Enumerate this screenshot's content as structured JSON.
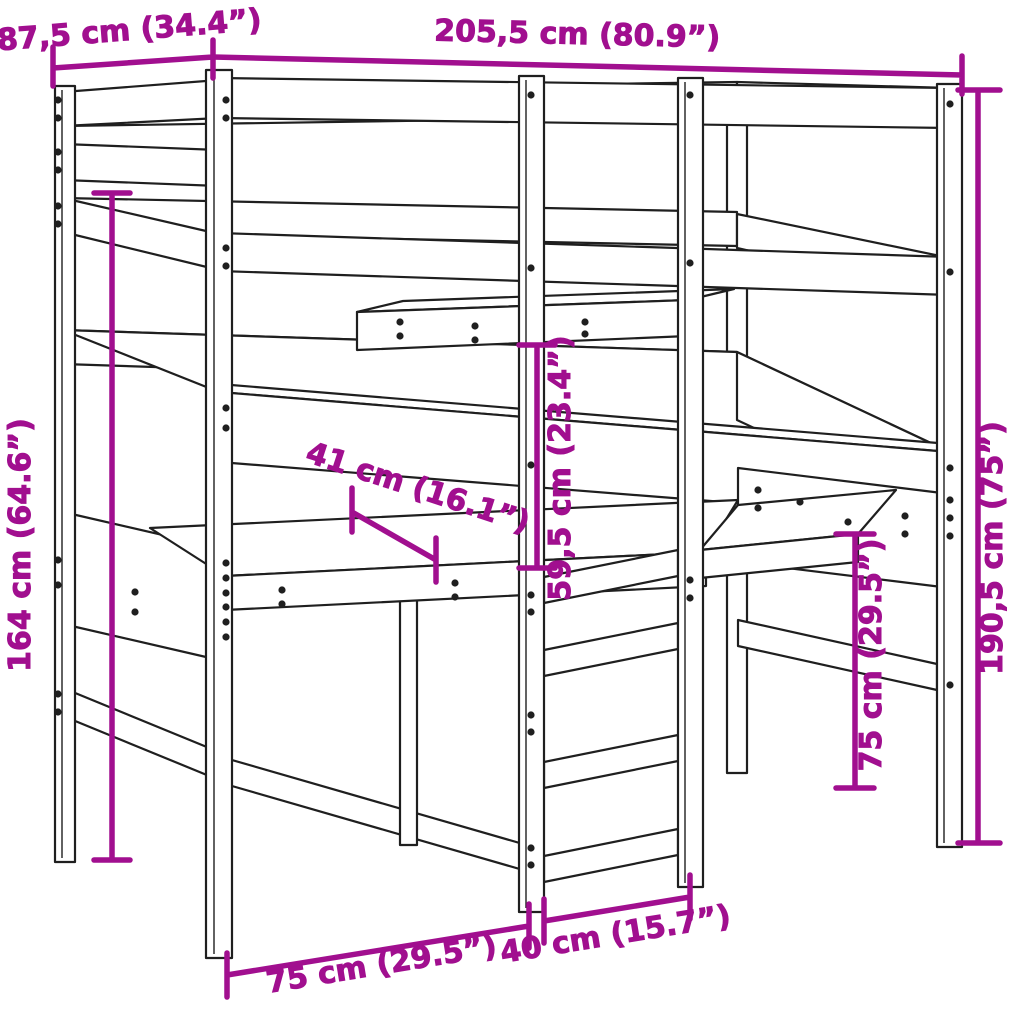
{
  "diagram": {
    "type": "furniture-dimension-diagram",
    "subject": "loft-bed-with-desks-and-ladder",
    "background": "#ffffff",
    "line_color": "#1f1f1f",
    "dimension_color": "#a10f8f",
    "dimensions": {
      "depth": "87,5 cm (34.4”)",
      "width": "205,5 cm (80.9”)",
      "height_left": "164 cm (64.6”)",
      "desk_depth": "41 cm (16.1”)",
      "shelf_clearance": "59,5 cm (23.4”)",
      "height_right": "190,5 cm (75”)",
      "desk_height": "75 cm (29.5”)",
      "floor_span": "75 cm (29.5”)",
      "ladder_width": "40 cm (15.7”)"
    }
  }
}
